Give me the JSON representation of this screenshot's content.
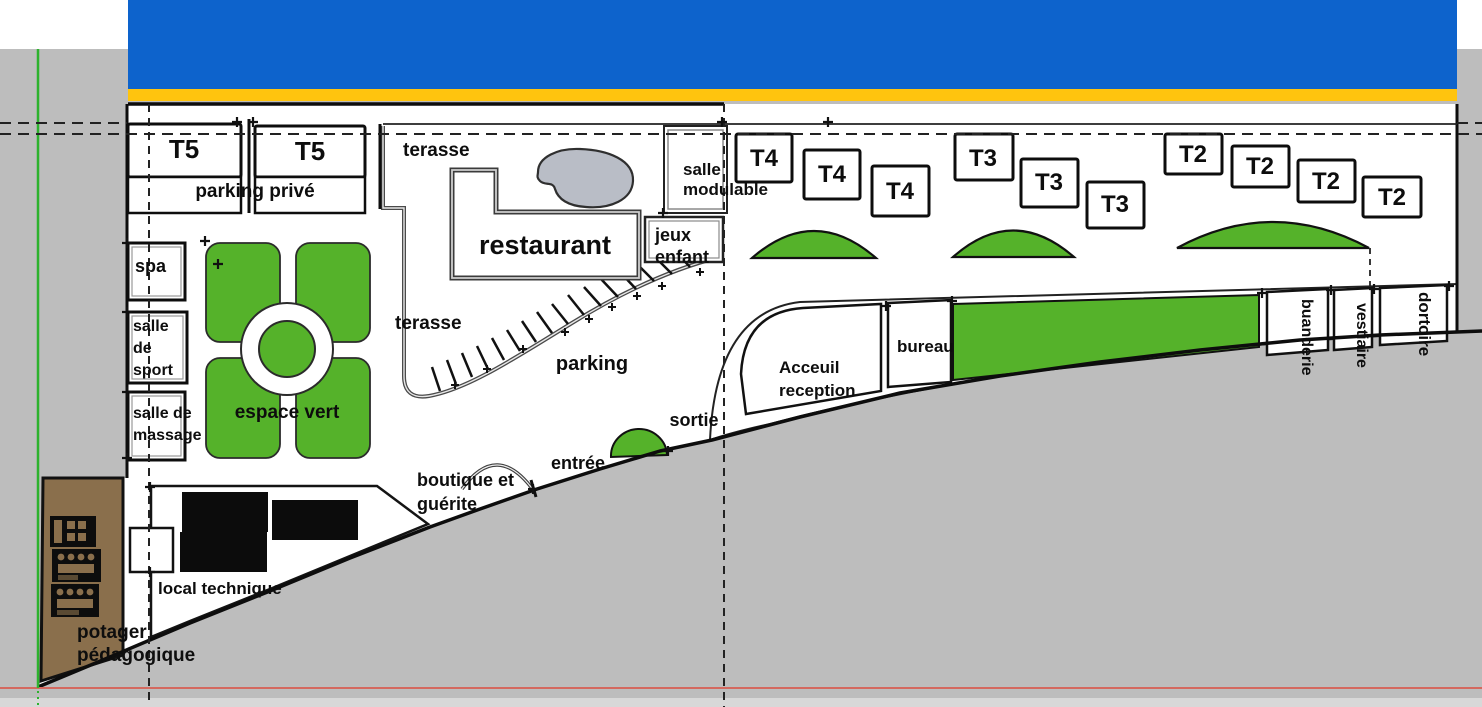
{
  "plan": {
    "units": {
      "t5_1": "T5",
      "t5_2": "T5",
      "t4_1": "T4",
      "t4_2": "T4",
      "t4_3": "T4",
      "t3_1": "T3",
      "t3_2": "T3",
      "t3_3": "T3",
      "t2_1": "T2",
      "t2_2": "T2",
      "t2_3": "T2",
      "t2_4": "T2"
    },
    "facilities": {
      "parking_prive": "parking privé",
      "terasse_haut": "terasse",
      "terasse_bas": "terasse",
      "restaurant": "restaurant",
      "salle_modulable": "salle\nmodulable",
      "jeux_enfant": "jeux\nenfant",
      "spa": "spa",
      "salle_de_sport": "salle\nde\nsport",
      "salle_de_massage": "salle de\nmassage",
      "espace_vert": "espace vert",
      "parking": "parking",
      "sortie": "sortie",
      "entree": "entrée",
      "boutique_guerite": "boutique et\nguérite",
      "accueil": "Acceuil\nreception",
      "bureau": "bureau",
      "buanderie": "buanderie",
      "vestiaire": "vestiaire",
      "dortoir": "dortoire",
      "local_technique": "local technique",
      "potager": "potager\npédagogique"
    },
    "colors": {
      "vegetation": "#55b22a",
      "road": "#0d63cc",
      "road_stripe": "#ffc40e",
      "ground": "#bdbdbd",
      "soil": "#8a6f4c",
      "water": "#b9bdc6",
      "axis_green": "#2db22d",
      "axis_red": "#d4695f"
    }
  }
}
